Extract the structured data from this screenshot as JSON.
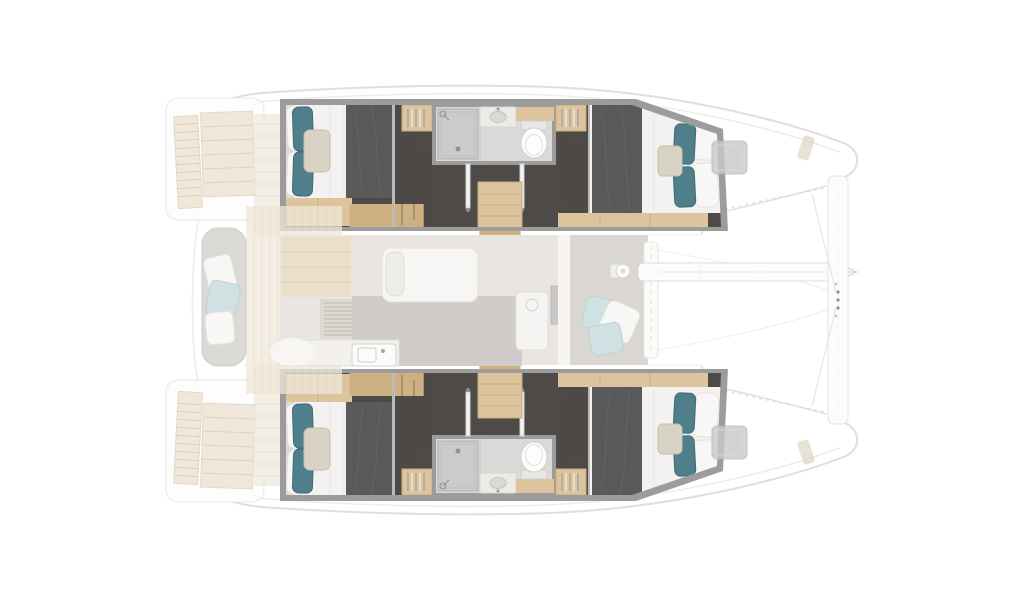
{
  "diagram": {
    "type": "yacht-floor-plan",
    "subject": "catamaran interior layout, top-down plan view, bow facing right",
    "visible_text": "",
    "port_hull": {
      "aft_cabin": {
        "item": "double-bed",
        "pillows": [
          "teal",
          "teal",
          "beige",
          "white",
          "white"
        ],
        "blanket": "dark-gray"
      },
      "wardrobes": 2,
      "bathroom": {
        "fixtures": [
          "shower",
          "sink",
          "toilet"
        ]
      },
      "companionway": {
        "item": "wood-steps-to-saloon",
        "doors": 2
      },
      "forward_cabin": {
        "item": "double-bed",
        "pillows": [
          "teal",
          "teal",
          "beige",
          "white",
          "white"
        ],
        "blanket": "dark-gray"
      }
    },
    "starboard_hull": {
      "aft_cabin": {
        "item": "double-bed",
        "pillows": [
          "teal",
          "teal",
          "beige",
          "white",
          "white"
        ],
        "blanket": "dark-gray"
      },
      "wardrobes": 2,
      "bathroom": {
        "fixtures": [
          "shower",
          "sink",
          "toilet"
        ]
      },
      "companionway": {
        "item": "wood-steps-to-saloon",
        "doors": 2
      },
      "forward_cabin": {
        "item": "double-bed",
        "pillows": [
          "teal",
          "teal",
          "beige",
          "white",
          "white"
        ],
        "blanket": "dark-gray"
      }
    },
    "center_deck": {
      "aft_cockpit": {
        "items": [
          "bench-seat",
          "cushions",
          "teak-floor"
        ]
      },
      "saloon": {
        "items": [
          "galley-counter",
          "sink-unit",
          "cabinets",
          "vent-locker",
          "chart-seat",
          "island-counter",
          "fridge"
        ]
      },
      "foredeck": {
        "items": [
          "scatter-cushions",
          "mast-foot"
        ]
      },
      "bow": {
        "items": [
          "forward-crossbeam",
          "boom",
          "bridle-lines",
          "trampoline-area"
        ]
      },
      "swim_platforms": 4,
      "deck_hatches": 2
    }
  },
  "colors": {
    "wall": "#9c9c9c",
    "floorDark": "#4e4a48",
    "wood": "#ddc49c",
    "woodDark": "#cdb183",
    "mattress": "#f3f2f0",
    "blanket": "#595a5c",
    "teal": "#4e7f8a",
    "tealEdge": "#3f6c77",
    "pillowWhite": "#f8f7f5",
    "pillowBeige": "#d9d3c6",
    "pillowBlue": "#cfe1e2",
    "bathFloor": "#dadad8",
    "shower": "#c9ccca",
    "fixture": "#fcfcfb",
    "hatch": "#c9c9c7",
    "teak": "#efe8da",
    "deckGray": "#dad7d3",
    "benchGray": "#dbd9d6",
    "outline": "#dfdfdf",
    "outlineSoft": "#ececea"
  }
}
